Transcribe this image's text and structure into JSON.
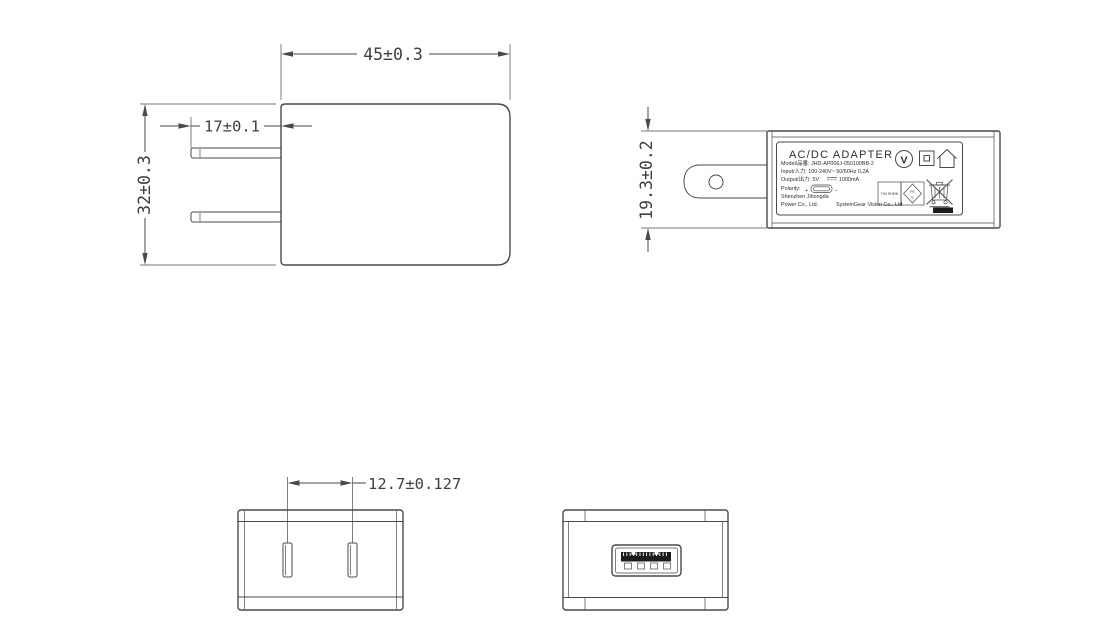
{
  "colors": {
    "background": "#ffffff",
    "line": "#4a4a4a",
    "text": "#3f3f3f",
    "solid_fill": "#1c1c1c"
  },
  "views": {
    "front": {
      "dims": {
        "width": "45±0.3",
        "blade_length": "17±0.1",
        "height": "32±0.3"
      }
    },
    "side": {
      "dims": {
        "thickness": "19.3±0.2"
      },
      "label": {
        "title": "AC/DC  ADAPTER",
        "model": "Model/品番: JHD-AP006J-050100BB-2",
        "input": "Input/入力: 100-240V~  50/60Hz  0,2A",
        "output_prefix": "Output/出力: 5V",
        "output_suffix": "1000mA",
        "polarity": "Polarity:",
        "plus": "+",
        "minus": "−",
        "company1": "Shenzhen Jihongda",
        "company2": "Power Co., Ltd.",
        "company3": "SystemGear Vision Co., Ltd",
        "cert_box": "TÜV RHEIN",
        "pse_top": "PS",
        "pse_bottom": "E",
        "v_mark": "V"
      }
    },
    "top": {
      "dims": {
        "pin_pitch": "12.7±0.127"
      }
    },
    "usb_face": {}
  },
  "icons": {
    "v_in_circle": "v-certification-mark",
    "class_ii": "double-square-class-ii",
    "indoor_use": "house-indoor-use-only",
    "pse_diamond": "pse-diamond-mark",
    "weee": "crossed-out-wheelie-bin",
    "dc_symbol": "solid-over-dashed-line",
    "micro_usb": "micro-usb-connector"
  }
}
